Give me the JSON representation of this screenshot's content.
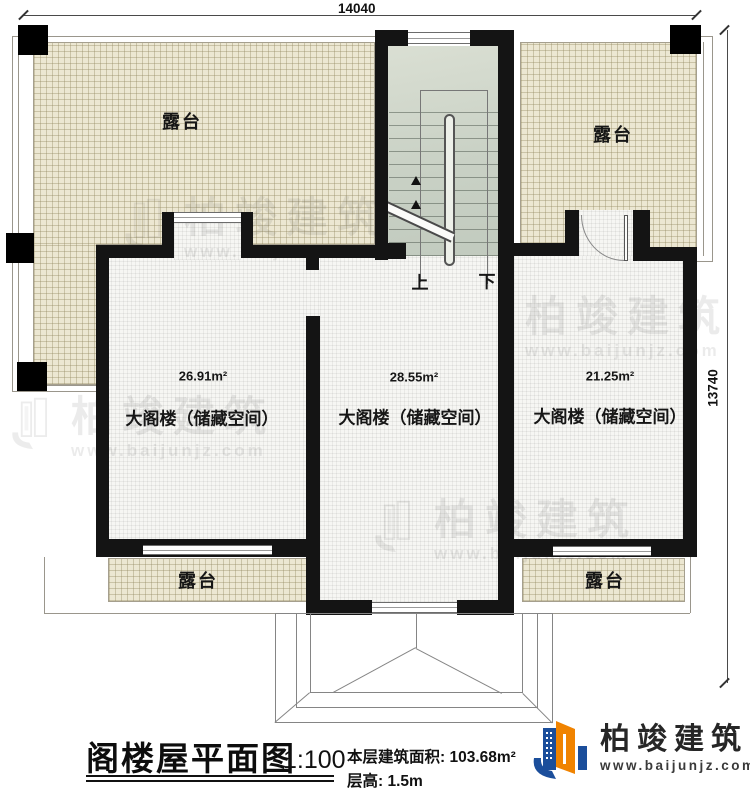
{
  "dimensions": {
    "width": "14040",
    "height": "13740"
  },
  "terraces": [
    "露台",
    "露台",
    "露台",
    "露台"
  ],
  "stairs": {
    "up": "上",
    "down": "下"
  },
  "rooms": [
    {
      "area": "26.91m²",
      "name": "大阁楼（储藏空间）"
    },
    {
      "area": "28.55m²",
      "name": "大阁楼（储藏空间）"
    },
    {
      "area": "21.25m²",
      "name": "大阁楼（储藏空间）"
    }
  ],
  "title_block": {
    "title": "阁楼屋平面图",
    "scale": "1:100",
    "area_line": "本层建筑面积: 103.68m²",
    "height_line": "层高: 1.5m"
  },
  "logo": {
    "name": "柏竣建筑",
    "website": "www.baijunjz.com"
  },
  "watermark": {
    "name": "柏竣建筑",
    "website": "www.baijunjz.com"
  },
  "colors": {
    "brand_blue": "#1b4e9b",
    "brand_orange": "#f08300",
    "wall": "#141414",
    "terrace_fill": "#ece7d2"
  }
}
